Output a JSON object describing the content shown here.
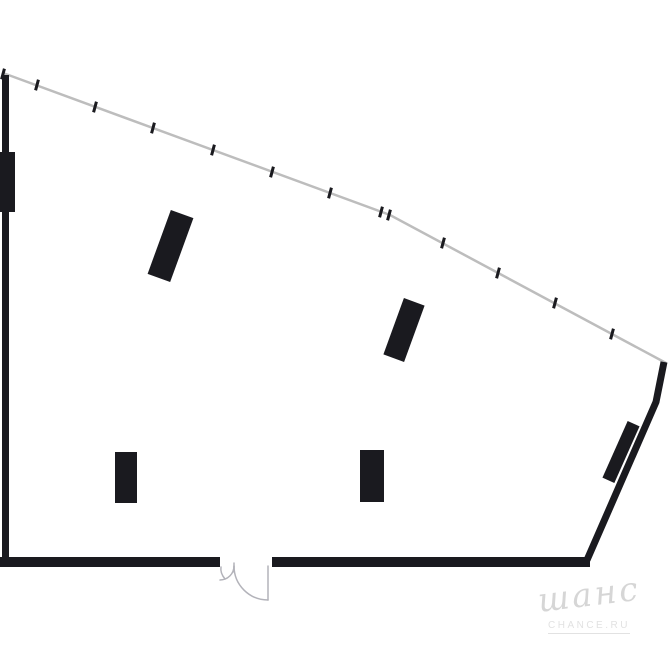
{
  "watermark": {
    "script_text": "шанс",
    "caption": "CHANCE.RU"
  },
  "colors": {
    "background": "#ffffff",
    "wall": "#1a1a1f",
    "facade_line": "#bdbdbd",
    "door": "#b3b3ba",
    "watermark_script": "#d6d6d6",
    "watermark_caption": "#e2e2e2"
  },
  "plan": {
    "canvas": {
      "width": 670,
      "height": 670
    },
    "wall_rects": [
      {
        "name": "left-wall",
        "x": 2,
        "y": 75,
        "w": 7,
        "h": 492
      },
      {
        "name": "left-wall-pier",
        "x": 0,
        "y": 152,
        "w": 15,
        "h": 60
      },
      {
        "name": "bottom-wall-left",
        "x": 0,
        "y": 557,
        "w": 220,
        "h": 10
      },
      {
        "name": "bottom-wall-right",
        "x": 272,
        "y": 557,
        "w": 318,
        "h": 10
      }
    ],
    "wall_paths": [
      {
        "name": "right-wall",
        "stroke_width": 7,
        "points": [
          [
            664,
            362
          ],
          [
            656,
            402
          ],
          [
            587,
            560
          ]
        ]
      }
    ],
    "columns": [
      {
        "name": "column-1",
        "cx": 170.5,
        "cy": 246,
        "w": 24,
        "h": 68,
        "angle": 20
      },
      {
        "name": "column-2",
        "cx": 404,
        "cy": 330,
        "w": 22,
        "h": 60,
        "angle": 20
      },
      {
        "name": "column-3",
        "cx": 126,
        "cy": 477.5,
        "w": 22,
        "h": 51,
        "angle": 0
      },
      {
        "name": "column-4",
        "cx": 372,
        "cy": 476,
        "w": 24,
        "h": 52,
        "angle": 0
      },
      {
        "name": "right-wall-pier",
        "cx": 621,
        "cy": 452,
        "w": 13,
        "h": 62,
        "angle": 24
      }
    ],
    "facade": {
      "points": [
        [
          3,
          73
        ],
        [
          390,
          215
        ],
        [
          666,
          363
        ]
      ],
      "line_width": 2.5,
      "tick_angle": 15,
      "tick_size": {
        "w": 3,
        "h": 11
      },
      "ticks": [
        [
          3,
          74
        ],
        [
          37,
          85
        ],
        [
          95,
          107
        ],
        [
          153,
          128
        ],
        [
          213,
          150
        ],
        [
          272,
          172
        ],
        [
          330,
          193
        ],
        [
          381,
          212
        ],
        [
          389,
          215
        ],
        [
          443,
          243
        ],
        [
          498,
          273
        ],
        [
          555,
          303
        ],
        [
          612,
          334
        ]
      ]
    },
    "door": {
      "stroke_width": 1.5,
      "paths": [
        "M 234 563 L 234 572",
        "M 221 567 Q 220 573 225 579",
        "M 234 566 A 14 14 0 0 1 220 580",
        "M 268 566 L 268 600",
        "M 234 566 A 34 34 0 0 0 268 600"
      ]
    }
  }
}
